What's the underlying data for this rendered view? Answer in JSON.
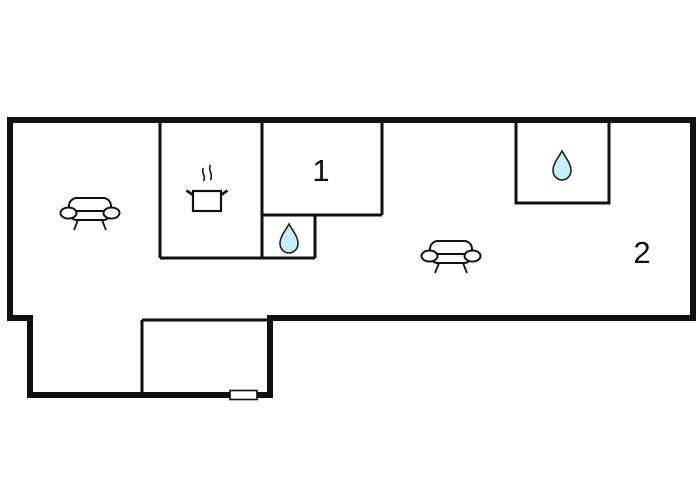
{
  "plan": {
    "type": "floor-plan",
    "rooms": [
      {
        "label": "1"
      },
      {
        "label": "2"
      }
    ],
    "icons": {
      "living_area_left": "sofa-icon",
      "living_area_right": "sofa-icon",
      "kitchen": "cooking-pot-icon",
      "bathroom_inner": "water-drop-icon",
      "bathroom_top_right": "water-drop-icon",
      "window_bottom": "window-icon"
    },
    "colors": {
      "background": "#ffffff",
      "wall": "#111111",
      "icon_stroke": "#111111",
      "water_fill": "#c6f0f5",
      "label": "#111111"
    }
  }
}
